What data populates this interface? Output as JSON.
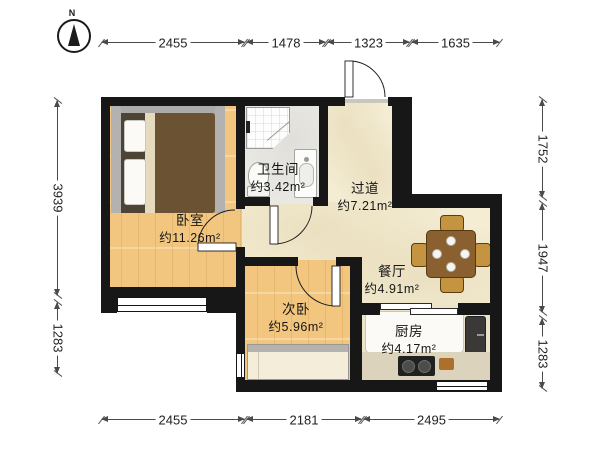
{
  "compass": {
    "north_label": "N"
  },
  "dimensions": {
    "top": [
      "2455",
      "1478",
      "1323",
      "1635"
    ],
    "bottom": [
      "2455",
      "2181",
      "2495"
    ],
    "left": [
      "3939",
      "1283"
    ],
    "right": [
      "1752",
      "1947",
      "1283"
    ]
  },
  "rooms": {
    "bedroom": {
      "name": "卧室",
      "area": "约11.26m²"
    },
    "bathroom": {
      "name": "卫生间",
      "area": "约3.42m²"
    },
    "hallway": {
      "name": "过道",
      "area": "约7.21m²"
    },
    "dining": {
      "name": "餐厅",
      "area": "约4.91m²"
    },
    "second_bedroom": {
      "name": "次卧",
      "area": "约5.96m²"
    },
    "kitchen": {
      "name": "厨房",
      "area": "约4.17m²"
    }
  },
  "colors": {
    "wall": "#171717",
    "wood_floor": "#f2c67e",
    "hall_floor": "#f4edd4",
    "bath_floor": "#eae8e3",
    "kitchen_floor": "#ece3cd",
    "bed_duvet": "#6a5233",
    "table_wood": "#8a6030",
    "dimension_text": "#1f1f1f"
  }
}
